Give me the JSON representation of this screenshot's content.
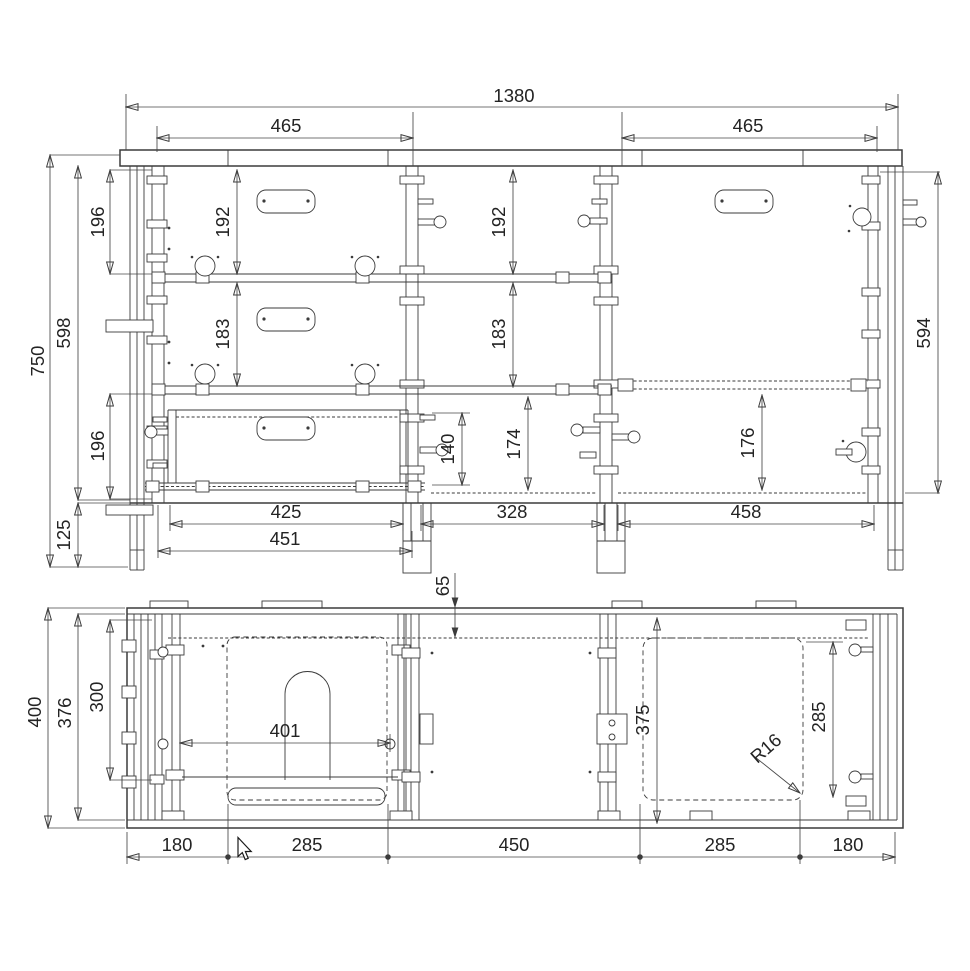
{
  "drawing": {
    "background_color": "#ffffff",
    "line_color": "#3b3b3b",
    "text_color": "#232323"
  },
  "front_view": {
    "overall_width": "1380",
    "bay_width_left": "465",
    "bay_width_right": "465",
    "overall_height": "750",
    "carcass_height": "598",
    "upper_offset": "196",
    "lower_offset": "196",
    "base_height": "125",
    "left_bay": {
      "top_drawer": "192",
      "middle_drawer": "183"
    },
    "mid_bay": {
      "top_opening": "192",
      "middle_opening": "183",
      "lower_opening": "174",
      "drawer_box": "140"
    },
    "right_bay": {
      "interior_height": "594",
      "lower_opening": "176"
    },
    "drawer_width": "425",
    "drawer_front_width": "451",
    "mid_opening_width": "328",
    "right_opening_width": "458",
    "back_offset": "65"
  },
  "plan_view": {
    "overall_depth": "400",
    "inner_depth": "376",
    "drawer_depth": "300",
    "drawer_width": "401",
    "door_depth": "375",
    "door_width": "285",
    "corner_radius": "R16",
    "width_chain": [
      "180",
      "285",
      "450",
      "285",
      "180"
    ]
  }
}
